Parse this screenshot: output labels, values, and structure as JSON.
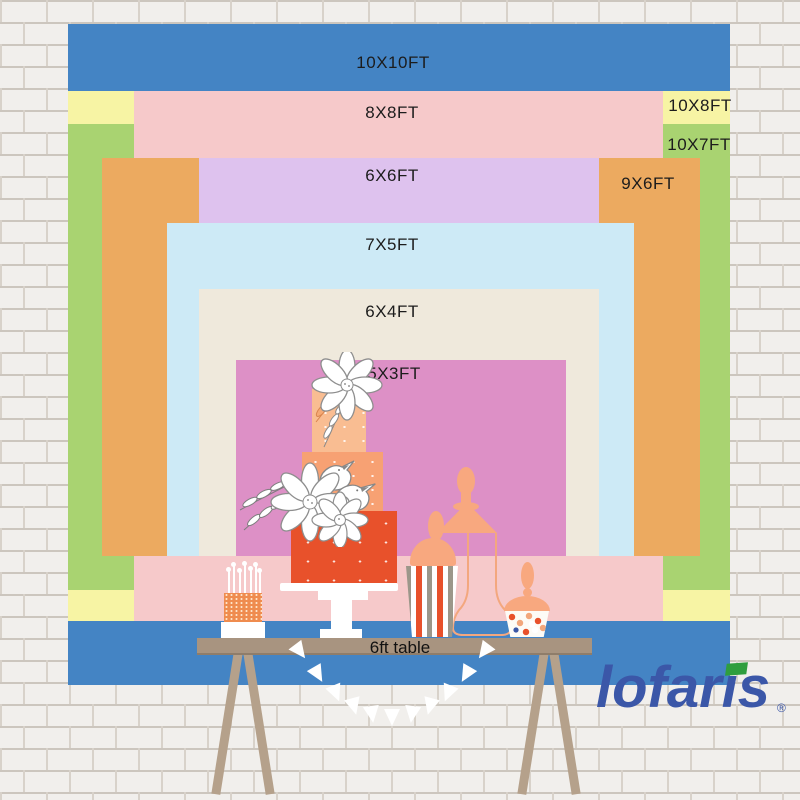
{
  "page": {
    "description": "Lofaris backdrop size comparison chart displayed on a white painted brick wall with a dessert table"
  },
  "sizes": {
    "s10x10": {
      "label": "10X10FT",
      "color": "#4484c4"
    },
    "s10x8": {
      "label": "10X8FT",
      "color": "#f7f4a4"
    },
    "s10x7": {
      "label": "10X7FT",
      "color": "#a9d371"
    },
    "s8x8": {
      "label": "8X8FT",
      "color": "#f6c9ca"
    },
    "s9x6": {
      "label": "9X6FT",
      "color": "#ecaa60"
    },
    "s6x6": {
      "label": "6X6FT",
      "color": "#dec2ee"
    },
    "s7x5": {
      "label": "7X5FT",
      "color": "#cdeaf6"
    },
    "s6x4": {
      "label": "6X4FT",
      "color": "#efe9dc"
    },
    "s5x3": {
      "label": "5X3FT",
      "color": "#dd90c6"
    }
  },
  "table": {
    "label": "6ft table",
    "color": "#a89480"
  },
  "brand": {
    "name": "lofaris",
    "registered_mark": "®",
    "color": "#3b57a8",
    "accent_color": "#2f9e3e"
  },
  "palette": {
    "wall": "#f1efec",
    "mortar": "#ccc6be",
    "cake_bottom_tier": "#e8512b",
    "cake_middle_tier": "#f7a173",
    "cake_top_tier": "#f9bd92",
    "peach_accent": "#f8a87f",
    "stripe_gray": "#9c978a",
    "candy_navy": "#3b57a6",
    "table_wood": "#b5a18b"
  }
}
